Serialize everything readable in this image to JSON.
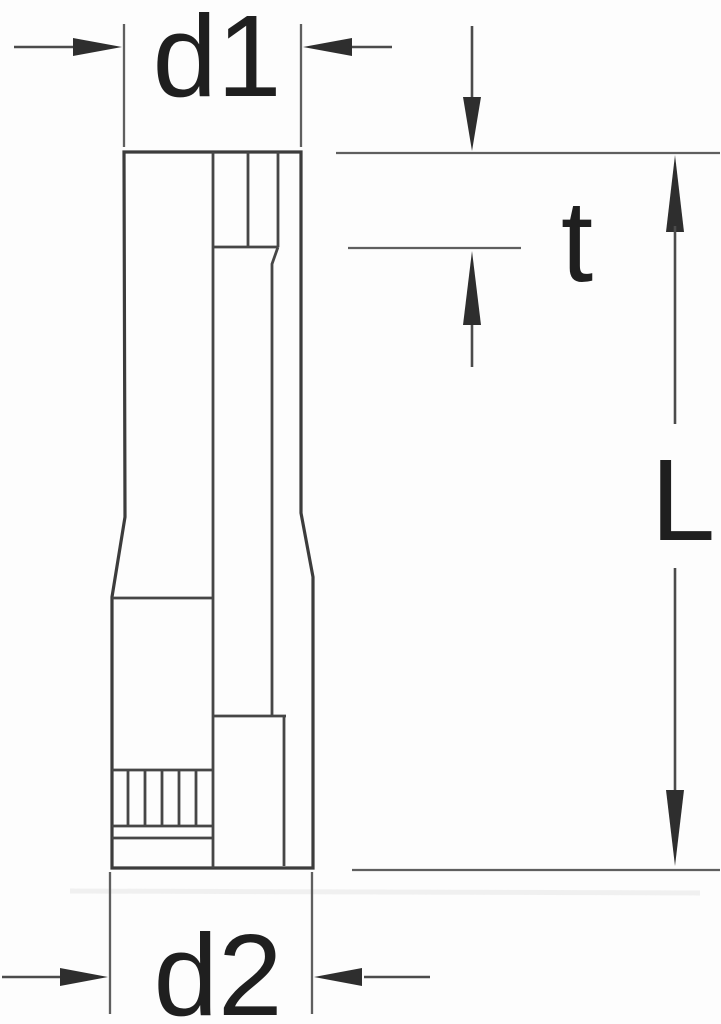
{
  "labels": {
    "d1": "d1",
    "t": "t",
    "L": "L",
    "d2": "d2"
  },
  "colors": {
    "background": "#fdfdfd",
    "line": "#3c3c3c",
    "inner_line": "#464646",
    "dim_line": "#4b4b4b",
    "ext_line": "#5f5f5f",
    "arrow": "#2e2e2e",
    "text": "#1f1f1f"
  }
}
